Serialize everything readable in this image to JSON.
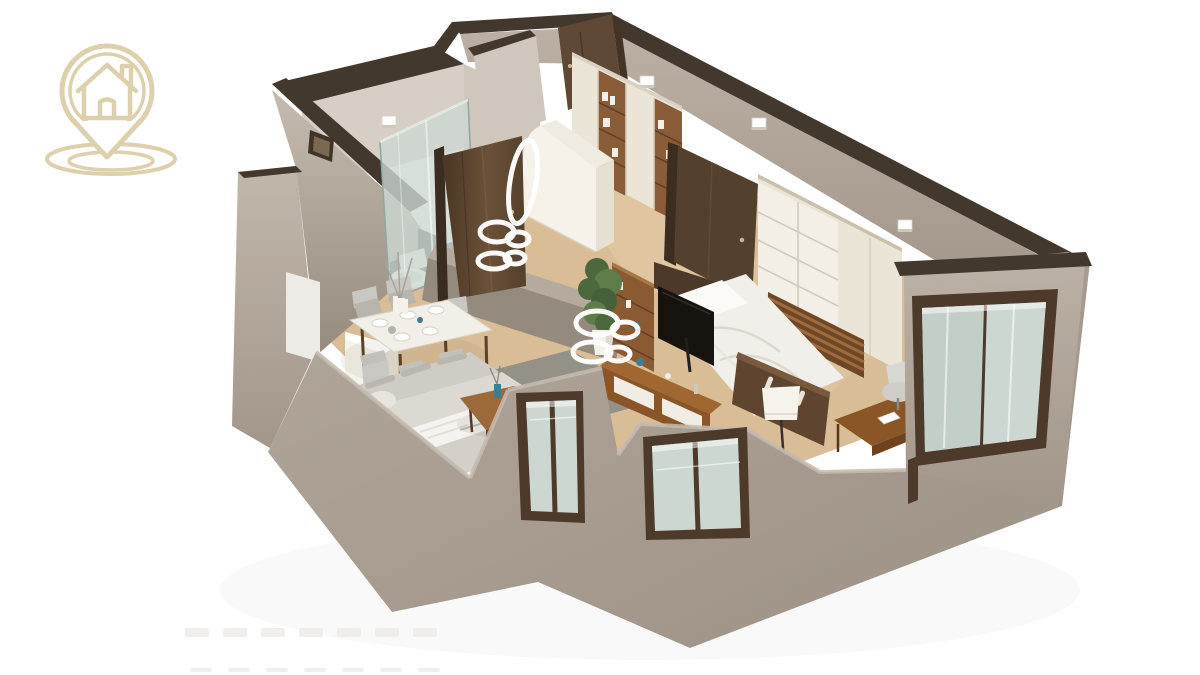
{
  "image": {
    "kind": "3d-apartment-floorplan-render",
    "width": 1200,
    "height": 675,
    "background": "#ffffff"
  },
  "logo": {
    "icon": "house-location-pin-icon",
    "color": "#dcd0ad"
  },
  "palette": {
    "bg": "#ffffff",
    "wallTop": "#42382d",
    "wallLight": "#c0b5a9",
    "wall": "#a89c90",
    "wallDark": "#8e8276",
    "wallInner": "#d7cfc6",
    "floor": "#d9bd97",
    "floorLight": "#e8d0ab",
    "plank": "#c2a078",
    "rug": "#908e86",
    "door": "#57422f",
    "doorDark": "#3c2d21",
    "cream": "#ebe5d7",
    "creamDark": "#d9d2c2",
    "shelfWood": "#8a5c38",
    "woodOrange": "#965f2d",
    "glass": "#ccd7d1",
    "frame": "#4e3a2a",
    "white": "#ffffff",
    "offWhite": "#f4f1ea",
    "bed": "#f1efe9",
    "sofa": "#d5d2cb",
    "tv": "#17130f",
    "plant": "#4c683d",
    "plant2": "#5f7d4a",
    "teal": "#3e7d92",
    "chair": "#c9c7c1"
  },
  "rooms": [
    {
      "name": "bathroom",
      "furniture": [
        "walk-in-shower",
        "toilet",
        "interior-door",
        "wall-cabinet"
      ]
    },
    {
      "name": "entry-hall",
      "furniture": [
        "entry-door",
        "built-in-wardrobes",
        "white-cabinet",
        "oval-mirror"
      ]
    },
    {
      "name": "bedroom",
      "furniture": [
        "double-bed",
        "wardrobe-shelving",
        "tv",
        "tv-stand",
        "wood-screen",
        "desk",
        "office-chair",
        "tripod-floor-lamp",
        "armchair",
        "window",
        "large-sliding-window"
      ]
    },
    {
      "name": "living-dining",
      "furniture": [
        "dining-table",
        "dining-chairs",
        "sofa",
        "coffee-table",
        "rug",
        "potted-plant",
        "kitchen-counter",
        "front-windows",
        "wall-picture",
        "wall-panel"
      ]
    }
  ],
  "ceiling_lights": {
    "color": "#ffffff",
    "rings": [
      {
        "cx": 597,
        "cy": 323,
        "rx": 21,
        "ry": 12,
        "rot": 0
      },
      {
        "cx": 625,
        "cy": 330,
        "rx": 13,
        "ry": 8,
        "rot": 0
      },
      {
        "cx": 592,
        "cy": 352,
        "rx": 19,
        "ry": 10,
        "rot": 0
      },
      {
        "cx": 618,
        "cy": 354,
        "rx": 12,
        "ry": 7,
        "rot": 0
      },
      {
        "cx": 497,
        "cy": 232,
        "rx": 17,
        "ry": 10,
        "rot": 0
      },
      {
        "cx": 518,
        "cy": 239,
        "rx": 11,
        "ry": 7,
        "rot": 0
      },
      {
        "cx": 494,
        "cy": 261,
        "rx": 16,
        "ry": 8,
        "rot": 0
      },
      {
        "cx": 515,
        "cy": 258,
        "rx": 10,
        "ry": 6,
        "rot": 0
      },
      {
        "cx": 523,
        "cy": 182,
        "rx": 13,
        "ry": 42,
        "rot": 9
      }
    ]
  },
  "wall_lights": [
    {
      "x": 382,
      "y": 116
    },
    {
      "x": 520,
      "y": 100
    },
    {
      "x": 640,
      "y": 76
    },
    {
      "x": 752,
      "y": 118
    },
    {
      "x": 898,
      "y": 220
    }
  ],
  "watermark": {
    "visible": true,
    "marks_row1": 7,
    "marks_row2": 7
  }
}
